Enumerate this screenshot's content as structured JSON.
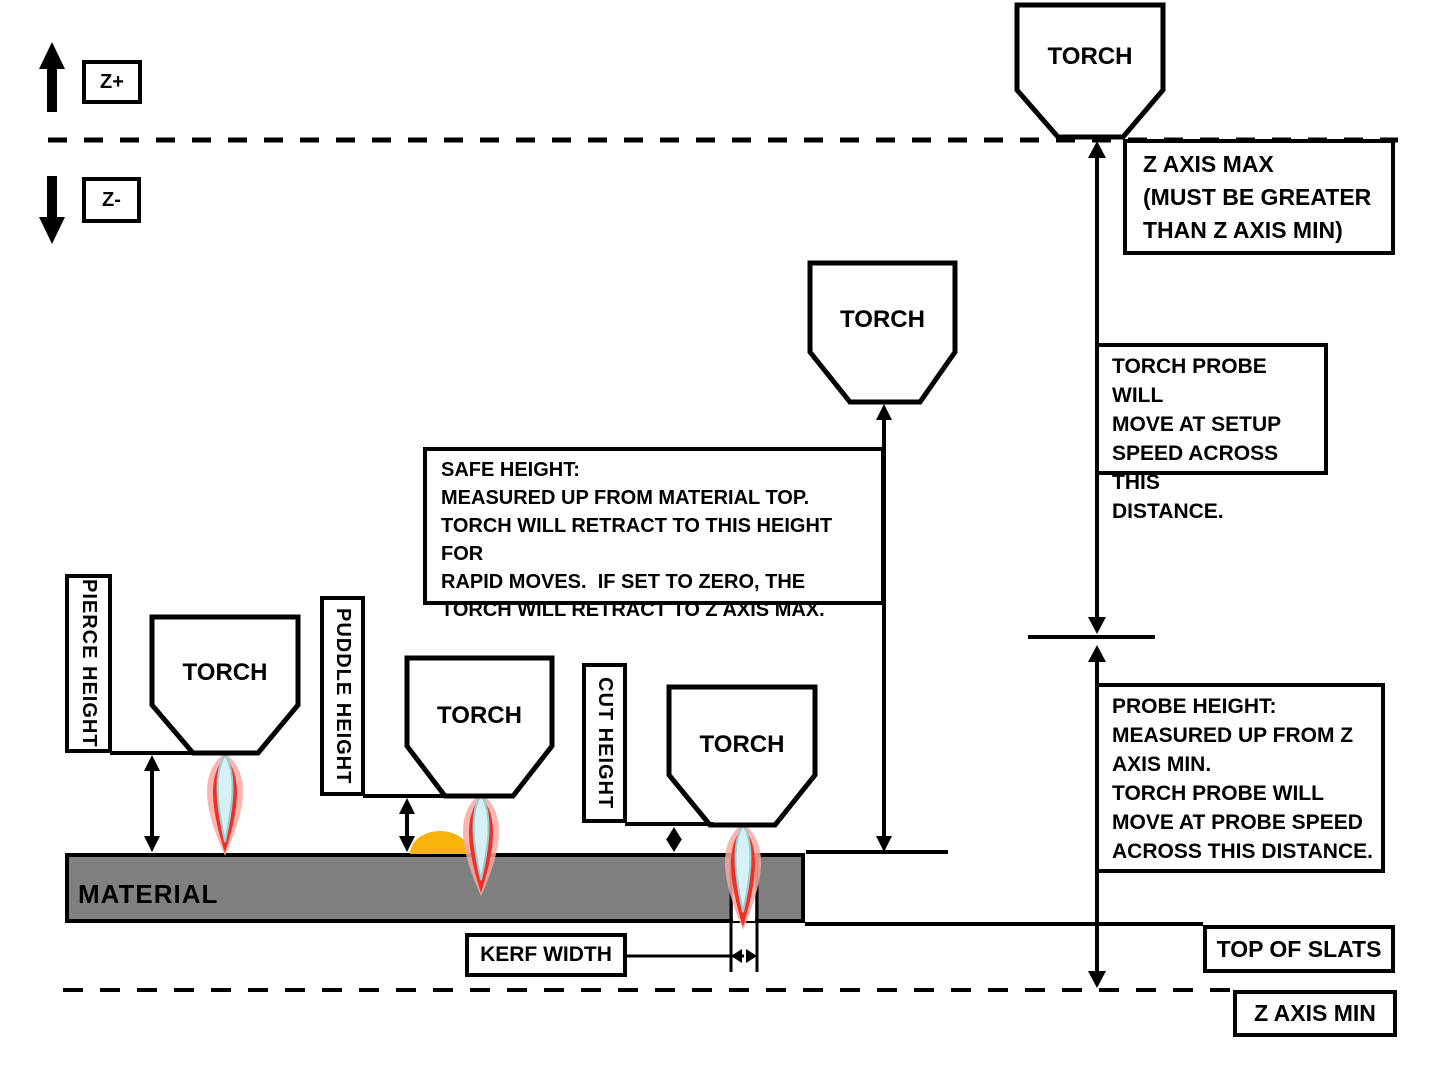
{
  "axis_labels": {
    "z_plus": "Z+",
    "z_minus": "Z-"
  },
  "torch_label": "TORCH",
  "material_label": "MATERIAL",
  "side_labels": {
    "pierce": "PIERCE HEIGHT",
    "puddle": "PUDDLE HEIGHT",
    "cut": "CUT HEIGHT"
  },
  "callouts": {
    "z_axis_max": "Z AXIS MAX\n(MUST BE GREATER\nTHAN Z AXIS MIN)",
    "torch_probe": "TORCH PROBE WILL\nMOVE AT SETUP\nSPEED ACROSS THIS\nDISTANCE.",
    "probe_height": "PROBE HEIGHT:\nMEASURED UP FROM Z\nAXIS MIN.\nTORCH PROBE WILL\nMOVE AT PROBE SPEED\nACROSS THIS DISTANCE.",
    "safe_height": "SAFE HEIGHT:\nMEASURED UP FROM MATERIAL TOP.\nTORCH WILL RETRACT TO THIS HEIGHT FOR\nRAPID MOVES.  IF SET TO ZERO, THE\nTORCH WILL RETRACT TO Z AXIS MAX.",
    "kerf_width": "KERF WIDTH",
    "top_of_slats": "TOP OF SLATS",
    "z_axis_min": "Z AXIS MIN"
  },
  "colors": {
    "line_black": "#000000",
    "material_gray": "#808080",
    "flame_red": "#EE3124",
    "flame_glow": "#F9A8A2",
    "flame_blue": "#D6F0F4",
    "flame_blue_edge": "#93CFD8",
    "puddle_gold": "#F6B40A"
  }
}
